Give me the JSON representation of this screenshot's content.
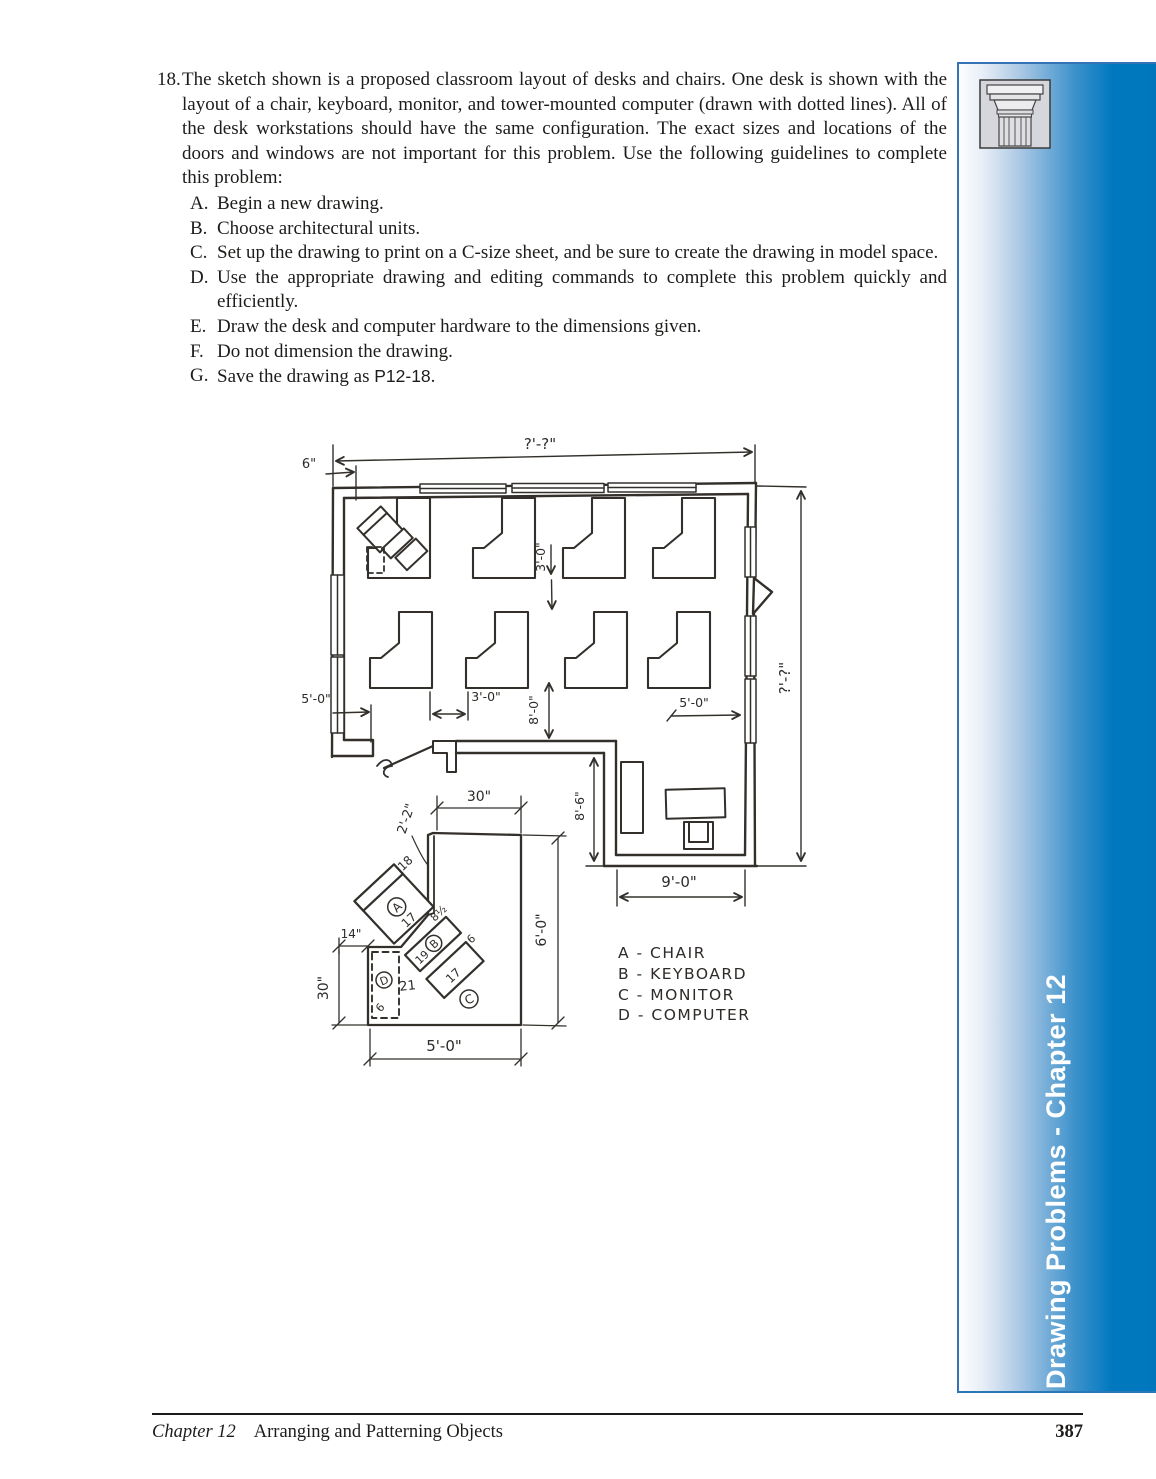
{
  "problem": {
    "number": "18.",
    "paragraph": "The sketch shown is a proposed classroom layout of desks and chairs. One desk is shown with the layout of a chair, keyboard, monitor, and tower-mounted computer (drawn with dotted lines). All of the desk workstations should have the same configuration. The exact sizes and locations of the doors and windows are not important for this problem. Use the following guidelines to complete this problem:",
    "steps": [
      {
        "letter": "A.",
        "text": "Begin a new drawing."
      },
      {
        "letter": "B.",
        "text": "Choose architectural units."
      },
      {
        "letter": "C.",
        "text": "Set up the drawing to print on a C-size sheet, and be sure to create the drawing in model space."
      },
      {
        "letter": "D.",
        "text": "Use the appropriate drawing and editing commands to complete this problem quickly and efficiently."
      },
      {
        "letter": "E.",
        "text": "Draw the desk and computer hardware to the dimensions given."
      },
      {
        "letter": "F.",
        "text": "Do not dimension the drawing."
      },
      {
        "letter": "G.",
        "text": "Save the drawing as ",
        "file": "P12-18",
        "suffix": "."
      }
    ]
  },
  "sketch": {
    "dims": {
      "top_width": "?'-?\"",
      "wall_offset": "6\"",
      "row_gap": "3'-0\"",
      "left_clearance": "5'-0\"",
      "desk_gap": "3'-0\"",
      "front_clearance": "8'-0\"",
      "right_clearance": "5'-0\"",
      "right_height": "?'-?\"",
      "alcove_height": "8'-6\"",
      "alcove_width": "9'-0\"",
      "detail_top": "30\"",
      "detail_return": "2'-2\"",
      "detail_right": "6'-0\"",
      "detail_step": "14\"",
      "detail_left": "30\"",
      "detail_bottom": "5'-0\"",
      "chair_width": "17",
      "chair_depth": "18",
      "keyboard_length": "19",
      "keyboard_depth": "8½",
      "monitor_length": "17",
      "monitor_depth": "6",
      "computer_length": "21",
      "computer_depth": "6"
    },
    "callouts": {
      "a": "A",
      "b": "B",
      "c": "C",
      "d": "D"
    },
    "legend": [
      "A - CHAIR",
      "B - KEYBOARD",
      "C - MONITOR",
      "D - COMPUTER"
    ]
  },
  "sidebar": {
    "title": "Drawing Problems - Chapter 12"
  },
  "footer": {
    "chapter": "Chapter 12",
    "section": "Arranging and Patterning Objects",
    "page": "387"
  }
}
